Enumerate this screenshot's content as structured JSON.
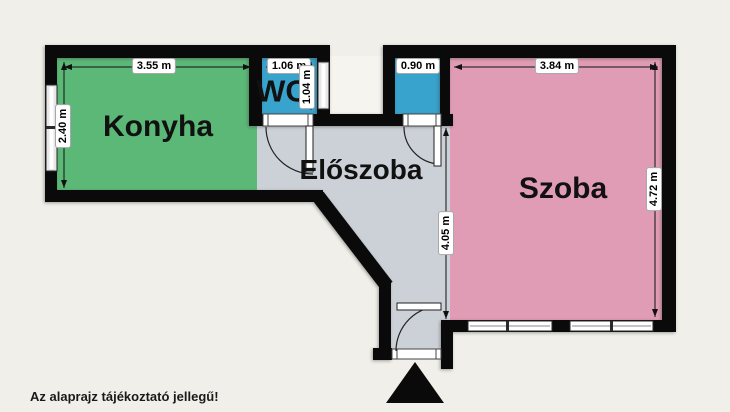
{
  "title": "Apartment floor plan",
  "disclaimer": "Az alaprajz tájékoztató jellegű!",
  "rooms": {
    "konyha": {
      "label": "Konyha"
    },
    "wc": {
      "label": "WC"
    },
    "eloszoba": {
      "label": "Előszoba"
    },
    "szoba": {
      "label": "Szoba"
    }
  },
  "dimensions": {
    "konyha_width": "3.55 m",
    "konyha_height": "2.40 m",
    "wc_width": "1.06 m",
    "wc_height": "1.04 m",
    "bathroom_width": "0.90 m",
    "szoba_width": "3.84 m",
    "szoba_height": "4.72 m",
    "hall_height": "4.05 m"
  },
  "icons": {
    "entrance": "entrance-arrow-icon",
    "windows": "window-icon",
    "doors": "door-swing-icon"
  },
  "colors": {
    "background": "#f0efe9",
    "wall": "#0a0a0a",
    "konyha": "#5bb877",
    "wet_rooms": "#38a3cd",
    "eloszoba": "#ccd1d8",
    "szoba": "#e09cb4",
    "dim_line": "#111111"
  }
}
